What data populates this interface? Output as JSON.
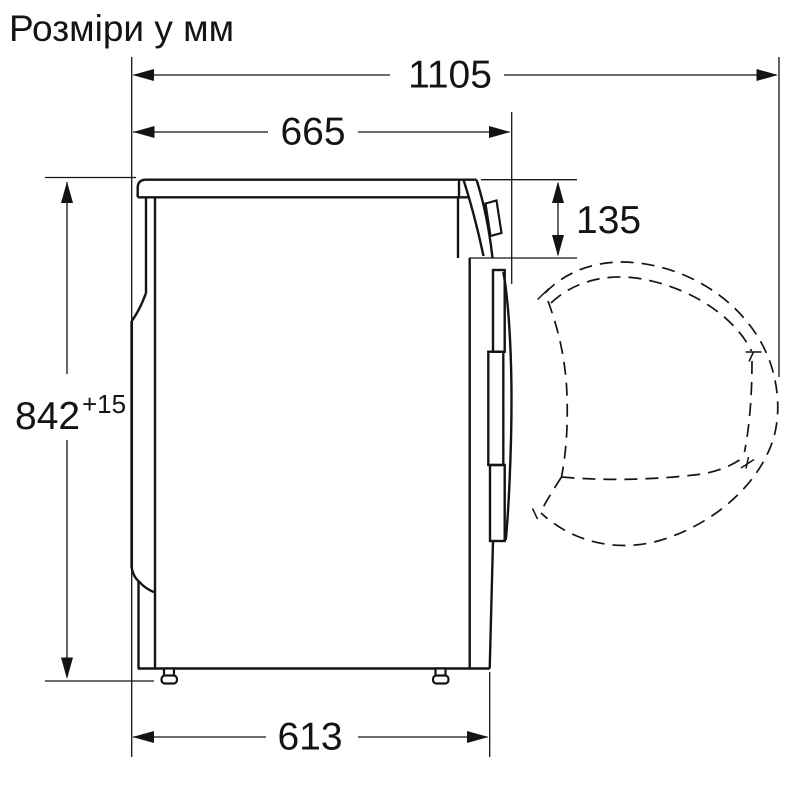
{
  "title": "Розміри у мм",
  "colors": {
    "line": "#141414",
    "background": "#ffffff"
  },
  "dimensions": {
    "overall_depth_door_open": "1105",
    "depth_total": "665",
    "top_panel_offset": "135",
    "height": "842",
    "height_tolerance": "+15",
    "base_depth": "613"
  }
}
